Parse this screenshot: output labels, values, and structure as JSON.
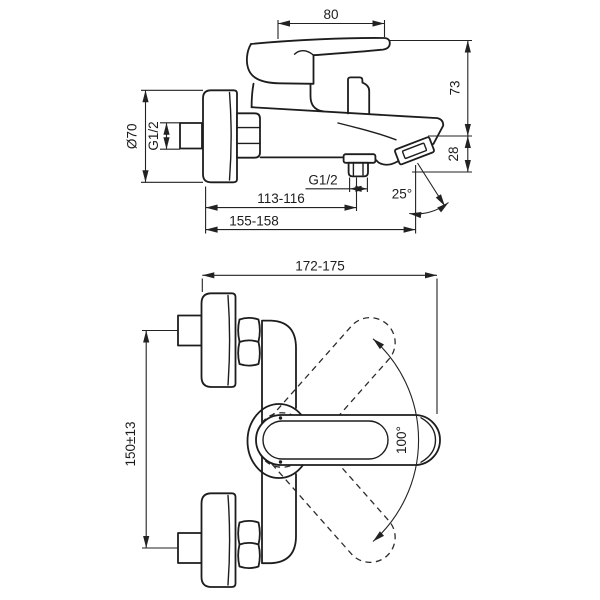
{
  "drawing": {
    "type": "technical-dimension-drawing",
    "subject": "wall-mounted single-lever bath shower mixer, two orthographic views",
    "background": "#ffffff",
    "line_color": "#1d1d1d",
    "side_view": {
      "dims": {
        "handle_length": "80",
        "handle_to_outlet_height": "73",
        "outlet_drop": "28",
        "flange_diameter": "Ø70",
        "wall_connection_thread": "G1/2",
        "hose_outlet_thread": "G1/2",
        "wall_to_hose_outlet": "113-116",
        "wall_to_spout_outlet": "155-158",
        "spout_outlet_angle": "25°"
      }
    },
    "front_view": {
      "dims": {
        "wall_to_handle_tip": "172-175",
        "inlet_connection_centres": "150±13",
        "handle_swivel_angle": "100°"
      }
    }
  }
}
